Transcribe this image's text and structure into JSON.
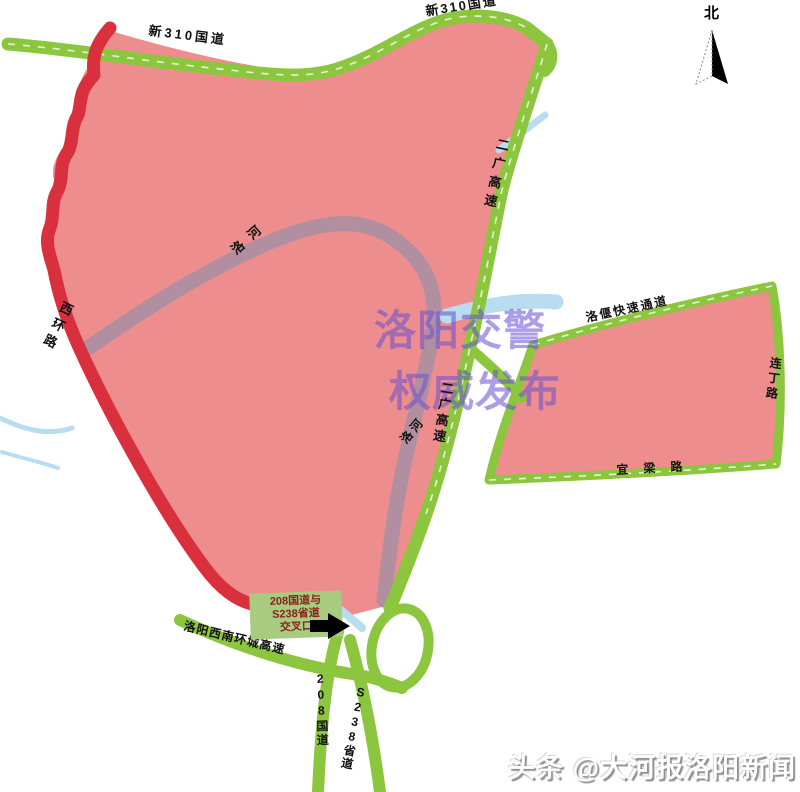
{
  "map": {
    "watermark": {
      "line1": "洛阳交警",
      "line2": "权威发布"
    },
    "north_label": "北",
    "roads": {
      "g310_label": "新310国道",
      "erguang_label": "二广高速",
      "west_ring_label": "西环路",
      "sw_ring_label": "洛阳西南环城高速",
      "g208_label": "208国道",
      "s238_label": "S238省道",
      "luoyan_expressway_label": "洛偃快速通道",
      "liangding_road_label": "连丁路",
      "yiliang_road_label": "宜梁路"
    },
    "rivers": {
      "luohe_label": "洛河"
    },
    "callout": {
      "line1": "208国道与",
      "line2": "S238省道",
      "line3": "交叉口"
    },
    "credit": "头条 @大河报洛阳新闻",
    "colors": {
      "zone": "#ee8d8d",
      "road_green": "#8cc63e",
      "road_red": "#d9303e",
      "river": "#b18fa0",
      "stream": "#b9ddf0",
      "watermark": "#6950d2",
      "callout_bg": "#a7cb7f",
      "callout_text": "#8b1f1f"
    }
  }
}
